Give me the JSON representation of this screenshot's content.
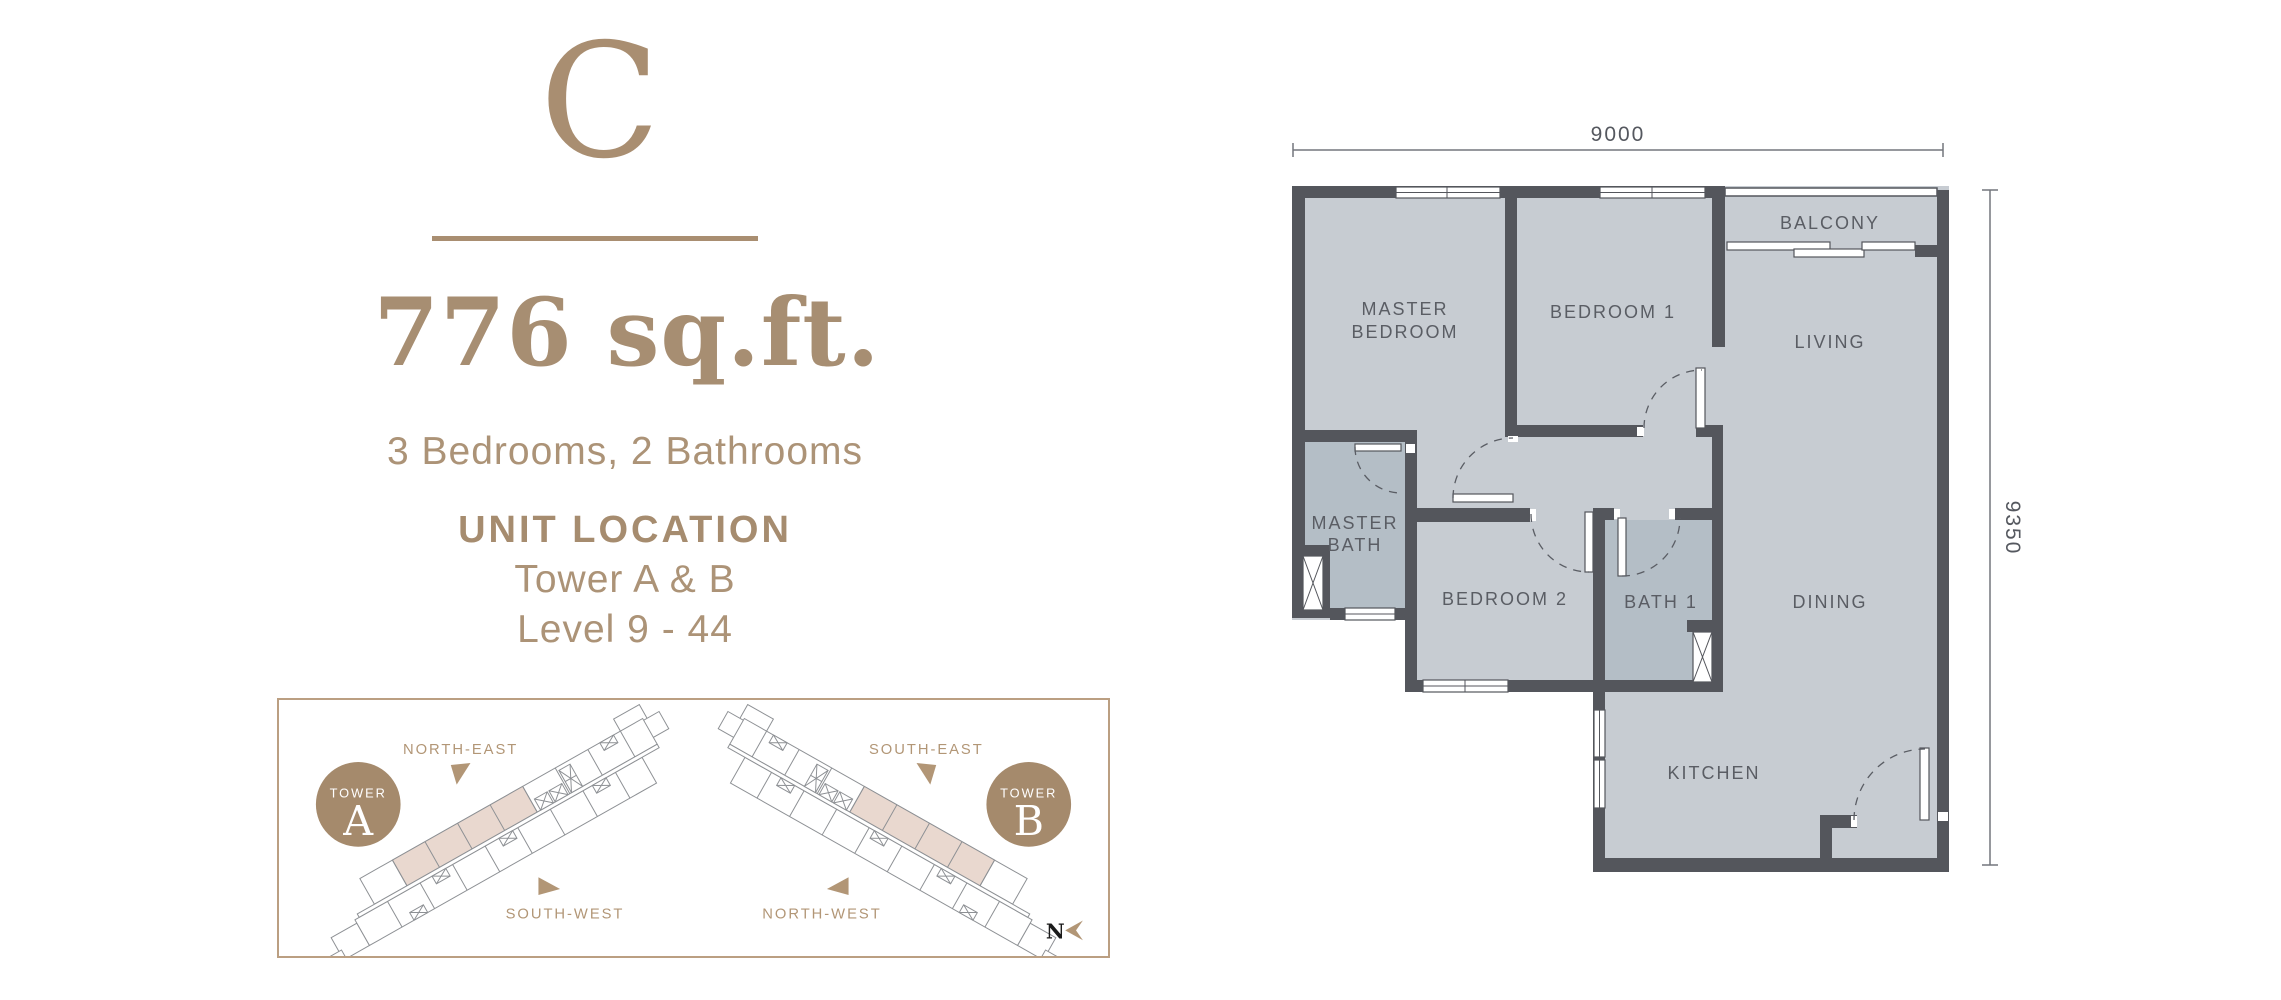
{
  "unit": {
    "letter": "C",
    "area": "776 sq.ft.",
    "config": "3 Bedrooms,  2 Bathrooms",
    "location_title": "UNIT LOCATION",
    "towers": "Tower A & B",
    "levels": "Level 9 - 44"
  },
  "location_diagram": {
    "tower_a": {
      "word": "TOWER",
      "letter": "A",
      "dir_top": "NORTH-EAST",
      "dir_bottom": "SOUTH-WEST"
    },
    "tower_b": {
      "word": "TOWER",
      "letter": "B",
      "dir_top": "SOUTH-EAST",
      "dir_bottom": "NORTH-WEST"
    },
    "north": "N"
  },
  "floor_plan": {
    "dim_top": "9000",
    "dim_right": "9350",
    "rooms": {
      "master_bedroom": [
        "MASTER",
        "BEDROOM"
      ],
      "bedroom1": "BEDROOM 1",
      "balcony": "BALCONY",
      "living": "LIVING",
      "master_bath": [
        "MASTER",
        "BATH"
      ],
      "bedroom2": "BEDROOM 2",
      "bath1": "BATH 1",
      "dining": "DINING",
      "kitchen": "KITCHEN"
    }
  },
  "colors": {
    "accent": "#a98e71",
    "accent_light": "#b29676",
    "wall": "#54565c",
    "floor": "#c7ccd2",
    "bath": "#b4bec6",
    "unit_highlight": "#e9d8cf",
    "label": "#5a5d64"
  }
}
